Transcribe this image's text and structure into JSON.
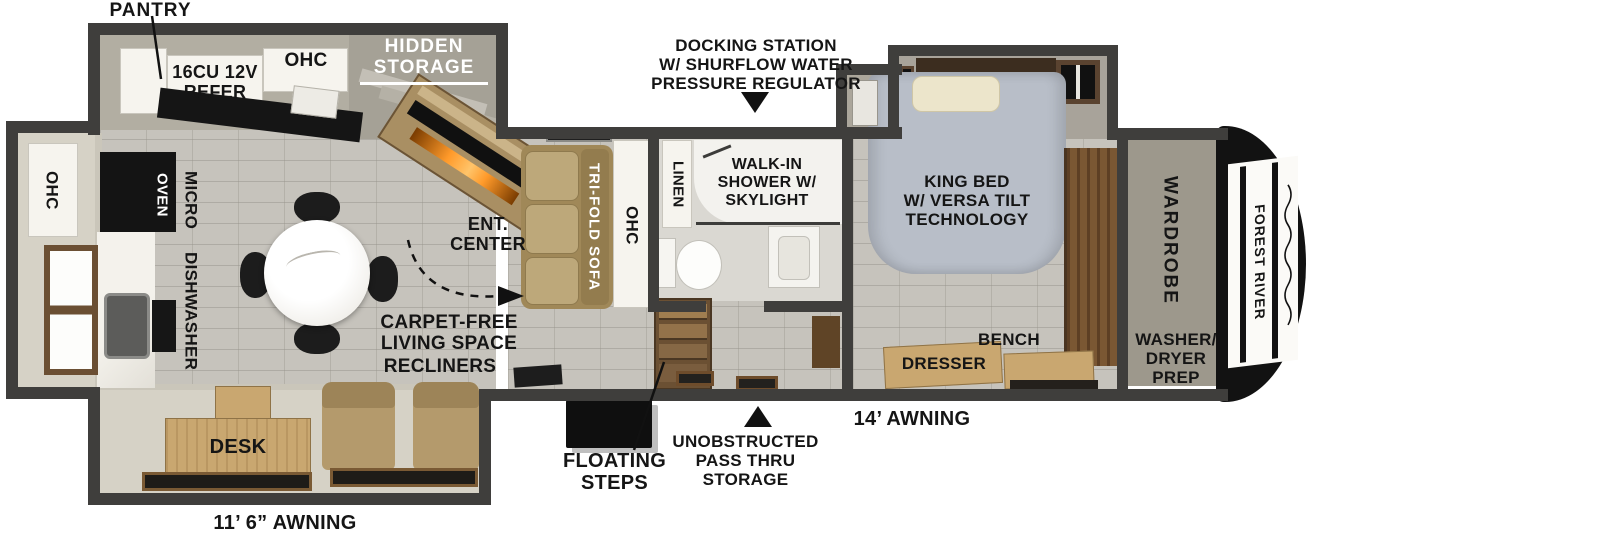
{
  "plan_name": "Fifth wheel RV floorplan",
  "colors": {
    "wall": "#3f3e3c",
    "tile_floor": "#c6c3bc",
    "slide_floor": "#d6d2c6",
    "cabinet_white": "#f6f4ee",
    "tan_furniture": "#b49a6c",
    "wood": "#c9a770",
    "bed_gray": "#b8bec8",
    "fireplace_orange": "#ff9a2a",
    "brand_black": "#121212"
  },
  "kitchen": {
    "pantry_label": "PANTRY",
    "refer_label": [
      "16CU 12V",
      "REFER"
    ],
    "ohc_top_label": "OHC",
    "ohc_slide_label": "OHC",
    "oven_label": "OVEN",
    "micro_label": "MICRO",
    "dishwasher_label": "DISHWASHER",
    "hidden_storage_label": [
      "HIDDEN",
      "STORAGE"
    ]
  },
  "living": {
    "ent_center_label": [
      "ENT.",
      "CENTER"
    ],
    "sofa_label": "TRI-FOLD SOFA",
    "ohc_sofa_label": "OHC",
    "carpet_free_label": [
      "CARPET-FREE",
      "LIVING SPACE"
    ],
    "recliners_label": "RECLINERS",
    "desk_label": "DESK"
  },
  "bathroom": {
    "linen_label": "LINEN",
    "shower_label": [
      "WALK-IN",
      "SHOWER W/",
      "SKYLIGHT"
    ]
  },
  "bedroom": {
    "king_bed_label": [
      "KING BED",
      "W/ VERSA TILT",
      "TECHNOLOGY"
    ],
    "bench_label": "BENCH",
    "dresser_label": "DRESSER"
  },
  "front_cap": {
    "wardrobe_label": "WARDROBE",
    "washer_dryer_label": [
      "WASHER/",
      "DRYER",
      "PREP"
    ],
    "brand_label": "FOREST RIVER"
  },
  "exterior": {
    "docking_label": [
      "DOCKING STATION",
      "W/ SHURFLOW WATER",
      "PRESSURE REGULATOR"
    ],
    "pass_thru_label": [
      "UNOBSTRUCTED",
      "PASS THRU",
      "STORAGE"
    ],
    "floating_steps_label": [
      "FLOATING",
      "STEPS"
    ],
    "awning_left_label": "11’ 6” AWNING",
    "awning_right_label": "14’ AWNING"
  }
}
